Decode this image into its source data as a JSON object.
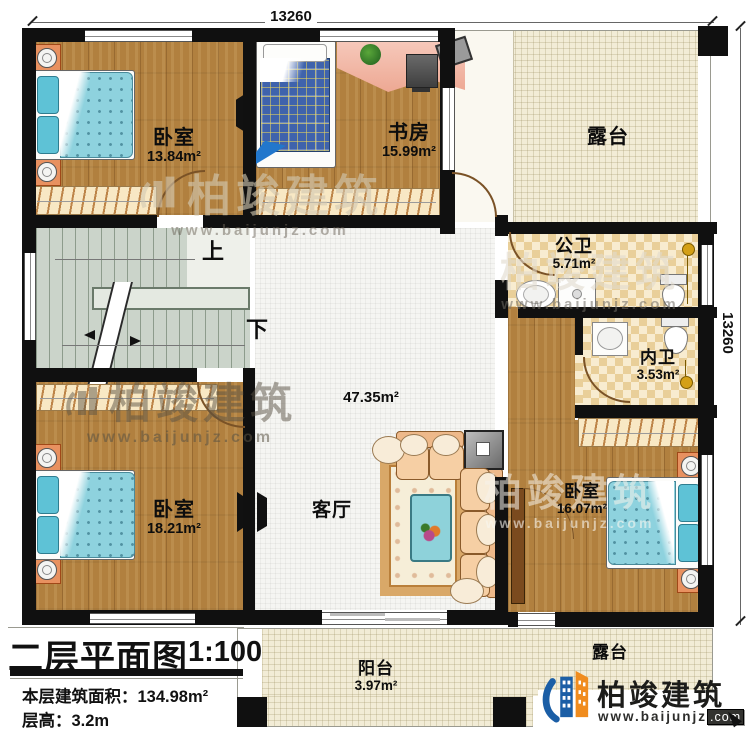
{
  "dimensions": {
    "top": "13260",
    "right": "13260"
  },
  "stairs": {
    "up_label": "上",
    "down_label": "下"
  },
  "rooms": {
    "bedroom_top_left": {
      "name": "卧室",
      "area": "13.84m²"
    },
    "study": {
      "name": "书房",
      "area": "15.99m²"
    },
    "terrace_top": {
      "name": "露台"
    },
    "public_bathroom": {
      "name": "公卫",
      "area": "5.71m²"
    },
    "private_bathroom": {
      "name": "内卫",
      "area": "3.53m²"
    },
    "living_room": {
      "name": "客厅",
      "area": "47.35m²"
    },
    "bedroom_bottom_left": {
      "name": "卧室",
      "area": "18.21m²"
    },
    "bedroom_bottom_right": {
      "name": "卧室",
      "area": "16.07m²"
    },
    "balcony": {
      "name": "阳台",
      "area": "3.97m²"
    },
    "terrace_bottom": {
      "name": "露台"
    }
  },
  "title_block": {
    "title": "二层平面图",
    "scale": "1:100",
    "floor_area_label": "本层建筑面积：",
    "floor_area_value": "134.98m²",
    "floor_height_label": "层高：",
    "floor_height_value": "3.2m"
  },
  "branding": {
    "company": "柏竣建筑",
    "website": "www.baijunjz",
    "website_tld": ".com"
  },
  "watermark": {
    "company": "柏竣建筑",
    "website": "www.baijunjz.com"
  },
  "colors": {
    "wall": "#101010",
    "wood": "#b1803f",
    "tile_light": "#f8ecd0",
    "tile_dark": "#e9cf99",
    "terrace": "#f2ecd6",
    "stairs": "#cbd4ca",
    "brand_blue": "#1b5ea6",
    "brand_orange": "#f08c1e"
  }
}
